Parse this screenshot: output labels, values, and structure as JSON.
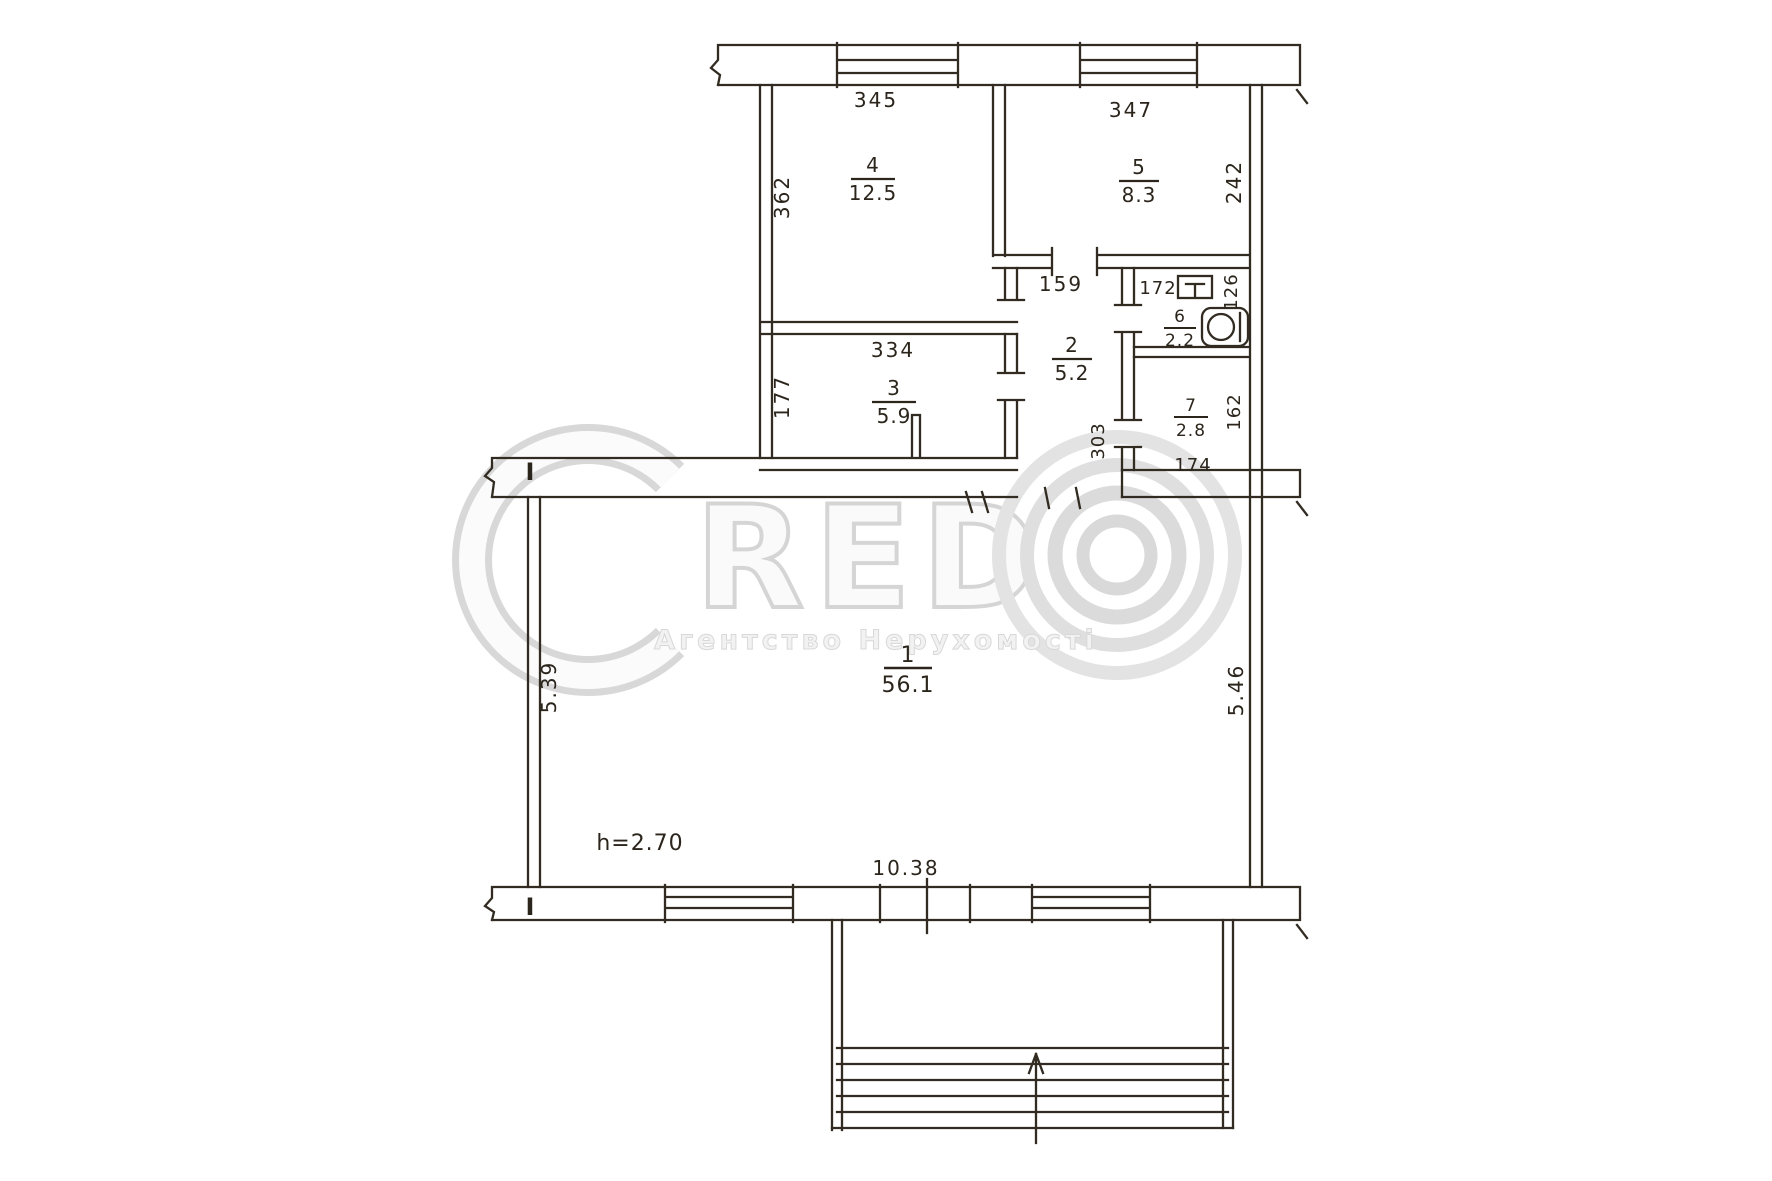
{
  "watermark": {
    "logo_letter": "C",
    "logo_text": "RED",
    "agency_text": "Агентство Нерухомості"
  },
  "plan": {
    "rooms": [
      {
        "number": "1",
        "area": "56.1"
      },
      {
        "number": "2",
        "area": "5.2"
      },
      {
        "number": "3",
        "area": "5.9"
      },
      {
        "number": "4",
        "area": "12.5"
      },
      {
        "number": "5",
        "area": "8.3"
      },
      {
        "number": "6",
        "area": "2.2"
      },
      {
        "number": "7",
        "area": "2.8"
      }
    ],
    "dims": {
      "r1_left": "5.39",
      "r1_right": "5.46",
      "r1_bottom": "10.38",
      "r1_height": "h=2.70",
      "r2_top": "159",
      "r2_right": "303",
      "r3_top": "334",
      "r3_left": "177",
      "r4_top": "345",
      "r4_left": "362",
      "r5_top": "347",
      "r5_right": "242",
      "r6_top": "172",
      "r6_right": "126",
      "r7_right": "162",
      "r7_bottom": "174"
    },
    "section_mark": "I"
  }
}
